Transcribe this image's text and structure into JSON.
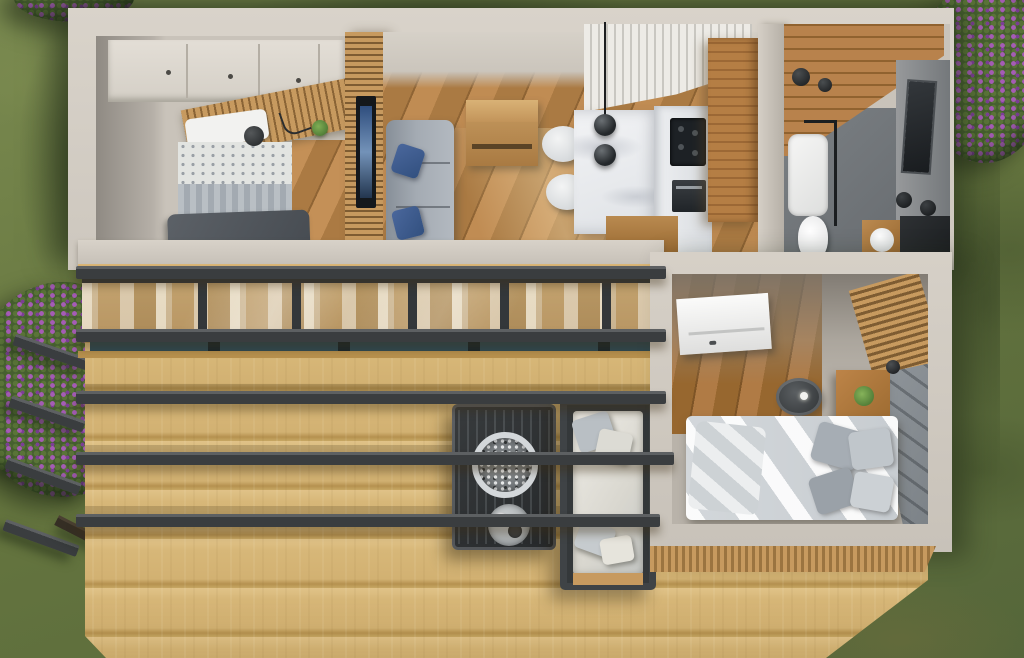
{
  "scene": {
    "type": "photorealistic-3d-render",
    "view": "top-down aerial cutaway",
    "subject": "modern prefab tiny house with wrap wooden deck and pergola, set on a lawn",
    "rooms": [
      "bedroom-left",
      "living-room",
      "kitchen",
      "bathroom",
      "bedroom-right",
      "deck"
    ],
    "furniture": {
      "bedroom_left": [
        "single bed with dark gray blanket",
        "white overhead cabinets",
        "wood slat headboard wall",
        "wall lamp",
        "hanging plant"
      ],
      "living_room": [
        "gray sofa with two blue pillows",
        "wall-mounted tv on slat partition",
        "wooden sideboard",
        "two white dining chairs"
      ],
      "kitchen": [
        "white marble l-shaped counter",
        "black cooktop and oven",
        "tall wooden cabinet column",
        "two black globe pendant lights",
        "white slat feature wall"
      ],
      "bathroom": [
        "wood plank wall",
        "gray floor",
        "white shower tray with glass screen",
        "toilet",
        "dark mirror",
        "wood vanity with round basin",
        "black counter"
      ],
      "bedroom_right": [
        "double bed with gray-white bedding and pillows",
        "quilted dark headboard wall",
        "wood slat accent wall",
        "white open door",
        "wooden nightstand with plant and black lamp",
        "round side table",
        "floor lamp",
        "glass sliding doors"
      ],
      "deck": [
        "five charcoal pergola beams",
        "outdoor sofa with white cushions",
        "fire pit table with pebble bowl and tray",
        "glazed sliding wall with sheer curtains"
      ]
    },
    "environment": [
      "grass lawn with worn patches",
      "purple flowering bush top-right",
      "purple flowering bush left",
      "small purple flowers top-left corner"
    ]
  },
  "palette": {
    "grass": "#6b7b47",
    "bush": "#46602f",
    "flower": "#a55cb5",
    "flowerDark": "#7c3f95",
    "wall": "#d3cdc4",
    "deckWood": "#d7b878",
    "slatWood": "#c79a5f",
    "kitchenWood": "#a9743c",
    "floorWood": "#b0辅4f",
    "beam": "#3a3d3f",
    "beamLight": "#5d6062",
    "marble": "#eef0f2",
    "sofaGray": "#9aa3ac",
    "pillowBlue": "#3f5d8f",
    "bedLinen": "#dde0e3",
    "bathFloor": "#72777b",
    "glassTeal": "#2e4a55"
  }
}
